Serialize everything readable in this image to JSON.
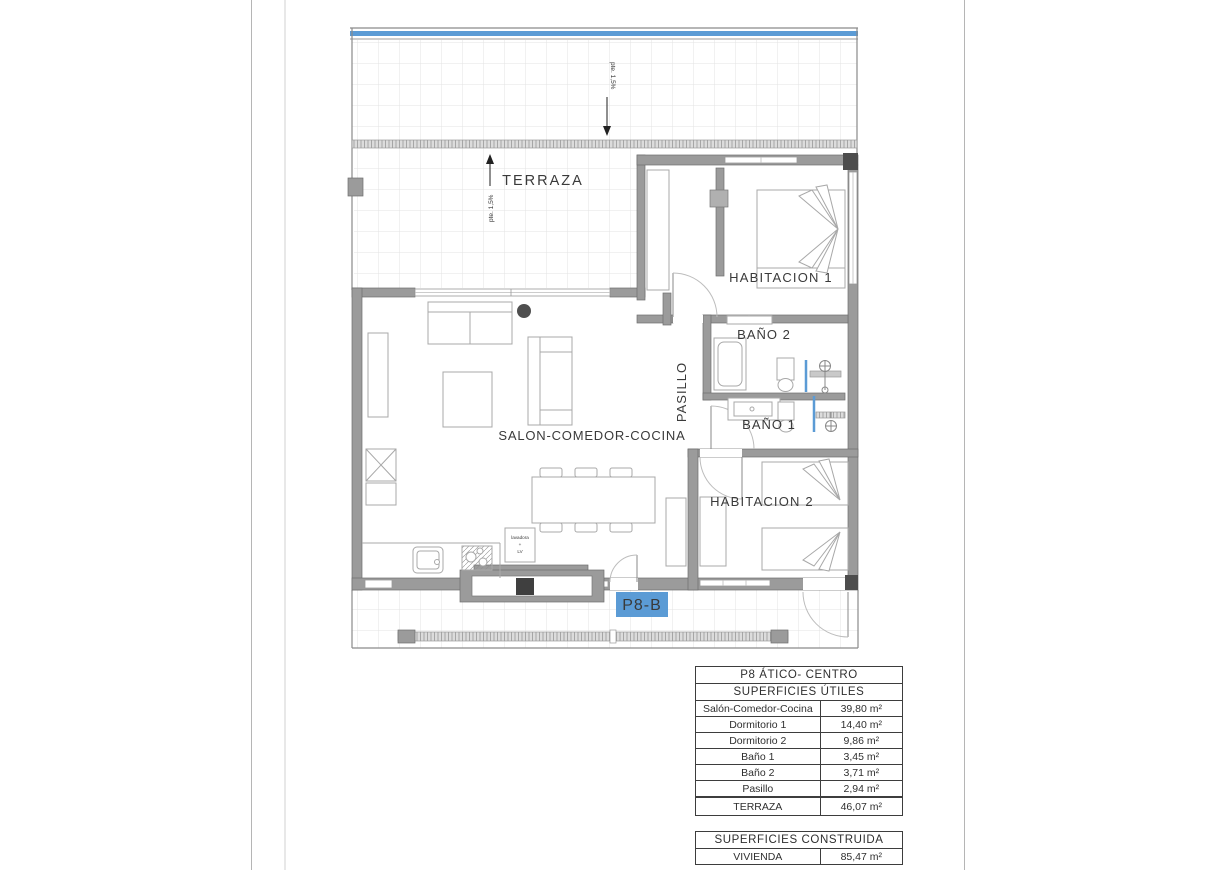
{
  "plan": {
    "labels": {
      "terraza": "TERRAZA",
      "habitacion1": "HABITACION 1",
      "habitacion2": "HABITACION 2",
      "bano2": "BAÑO 2",
      "bano1": "BAÑO 1",
      "pasillo": "PASILLO",
      "salon": "SALON-COMEDOR-COCINA",
      "unit": "P8-B"
    },
    "annotations": {
      "slope_roof": "pte. 1,5%",
      "slope_terrace": "pte. 1,5%",
      "appliance_line1": "lavadora",
      "appliance_line2": "+",
      "appliance_line3": "LV"
    },
    "colors": {
      "wall": "#9b9b9b",
      "accent_blue": "#5b9bd5",
      "tile_line": "#e3e3e3"
    }
  },
  "tables": {
    "useful": {
      "title": "P8 ÁTICO- CENTRO",
      "subtitle": "SUPERFICIES ÚTILES",
      "rows": [
        {
          "label": "Salón-Comedor-Cocina",
          "value": "39,80 m²"
        },
        {
          "label": "Dormitorio 1",
          "value": "14,40 m²"
        },
        {
          "label": "Dormitorio 2",
          "value": "9,86 m²"
        },
        {
          "label": "Baño 1",
          "value": "3,45 m²"
        },
        {
          "label": "Baño 2",
          "value": "3,71 m²"
        },
        {
          "label": "Pasillo",
          "value": "2,94 m²"
        }
      ]
    },
    "terrace_row": {
      "label": "TERRAZA",
      "value": "46,07 m²"
    },
    "built": {
      "title": "SUPERFICIES CONSTRUIDA",
      "rows": [
        {
          "label": "VIVIENDA",
          "value": "85,47 m²"
        }
      ]
    }
  }
}
